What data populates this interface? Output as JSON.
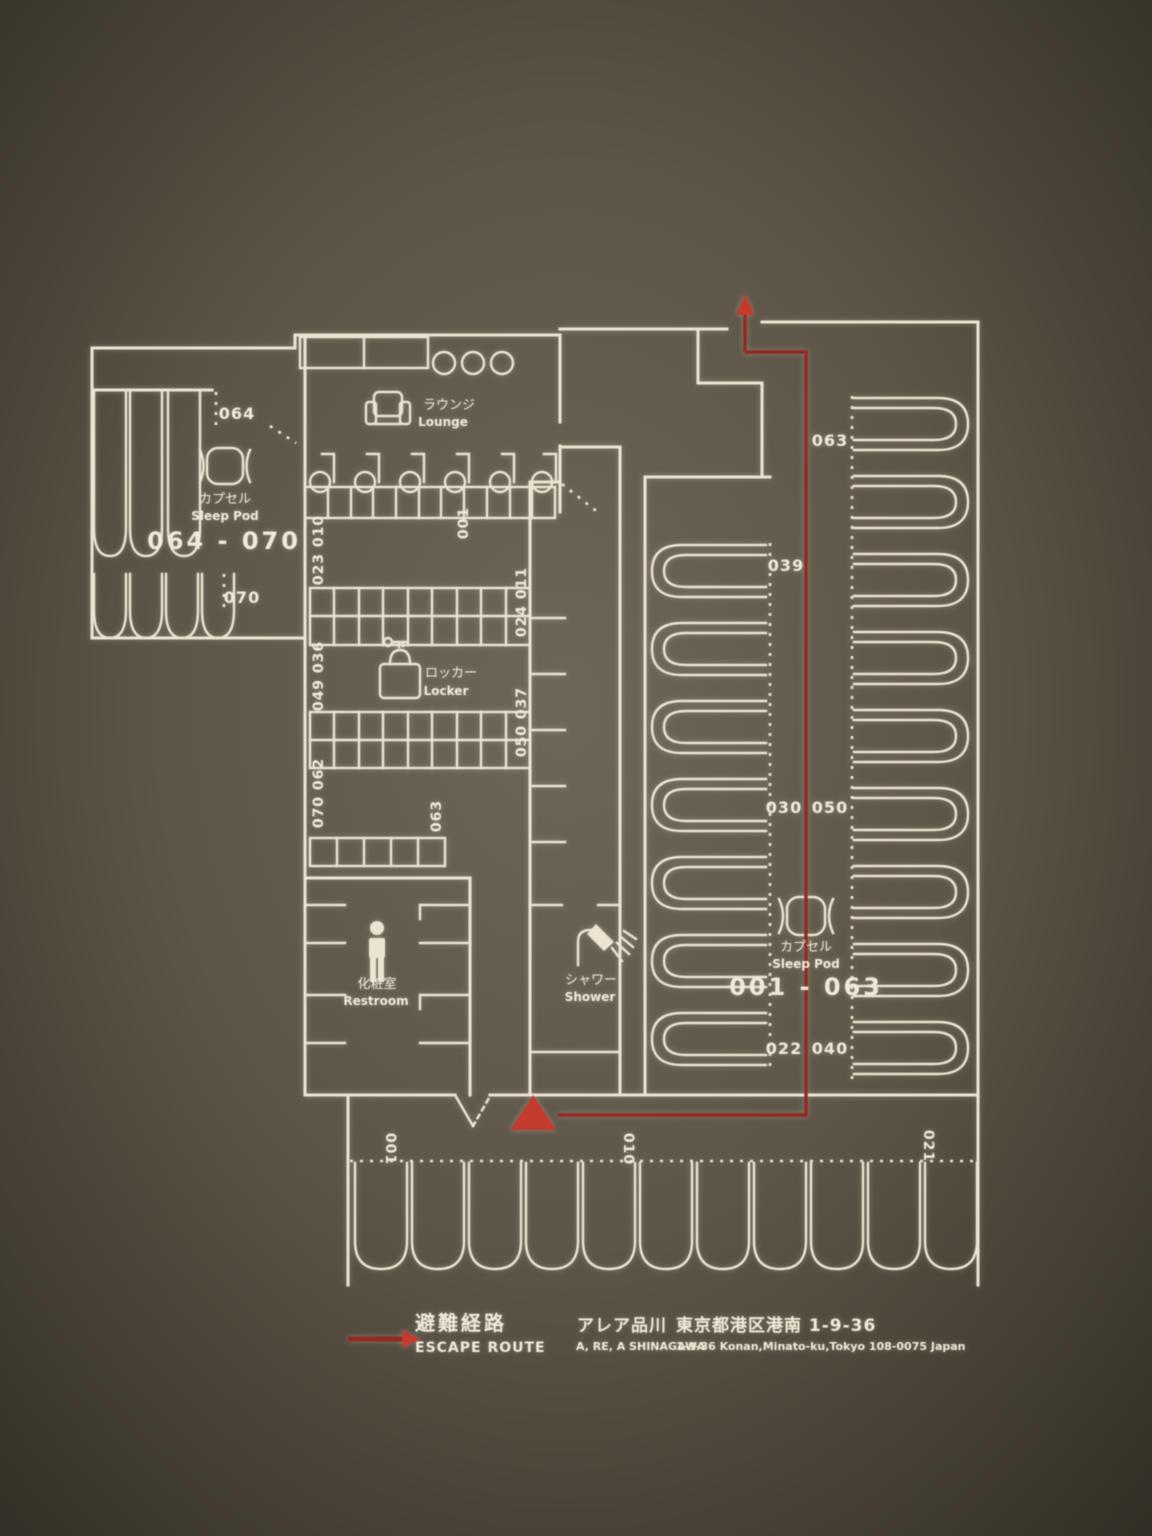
{
  "sign": {
    "type": "floor-plan-escape-route-sign",
    "facility_jp": "アレア品川",
    "facility_en": "A, RE, A SHINAGAWA"
  },
  "colors": {
    "bg": "#6e6757",
    "bgEdge": "#2e2a22",
    "line": "#ebe4d2",
    "text": "#f0e9d8",
    "red": "#952a20",
    "redArrow": "#c33b2d"
  },
  "areas": {
    "lounge": {
      "jp": "ラウンジ",
      "en": "Lounge"
    },
    "locker": {
      "jp": "ロッカー",
      "en": "Locker"
    },
    "restroom": {
      "jp": "化粧室",
      "en": "Restroom"
    },
    "shower": {
      "jp": "シャワー",
      "en": "Shower"
    },
    "sleep_pod_left": {
      "jp": "カプセル",
      "en": "Sleep Pod",
      "range": "064 - 070"
    },
    "sleep_pod_main": {
      "jp": "カプセル",
      "en": "Sleep Pod",
      "range": "001 - 063"
    }
  },
  "pod_labels": {
    "left_wing": [
      "064",
      "070"
    ],
    "locker_left": [
      "023 010",
      "049 036",
      "070 062"
    ],
    "locker_right": [
      "001",
      "024 011",
      "050 037",
      "063"
    ],
    "hall": [
      "063",
      "039",
      "030",
      "050",
      "022",
      "040"
    ],
    "bottom": [
      "001",
      "010",
      "021"
    ]
  },
  "legend": {
    "escape_route_jp": "避難経路",
    "escape_route_en": "ESCAPE ROUTE",
    "facility_jp": "アレア品川",
    "facility_en": "A, RE, A SHINAGAWA",
    "address_jp": "東京都港区港南 1-9-36",
    "address_en": "1-9-36 Konan,Minato-ku,Tokyo 108-0075 Japan"
  }
}
